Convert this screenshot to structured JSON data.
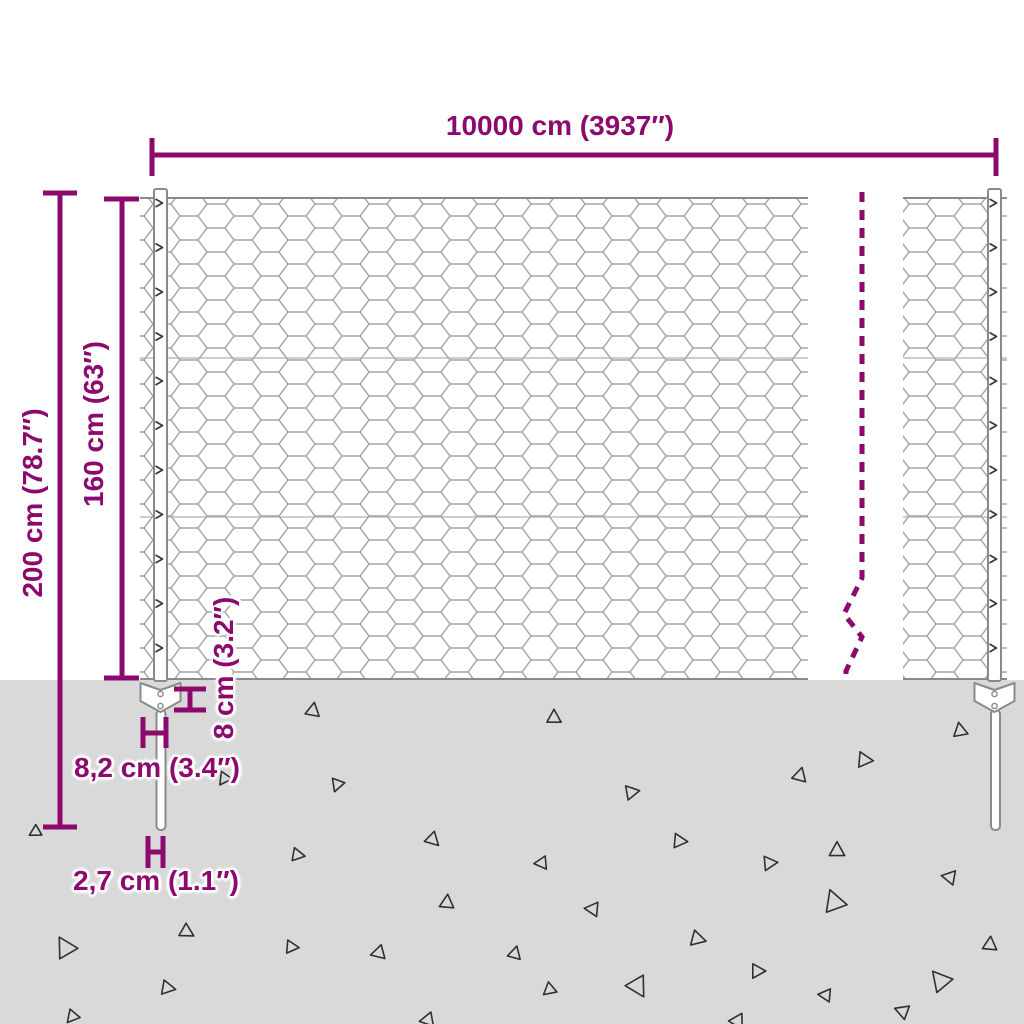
{
  "labels": {
    "total_width": "10000 cm (3937″)",
    "total_height": "200 cm (78.7″)",
    "mesh_height": "160 cm (63″)",
    "plate_height": "8 cm (3.2″)",
    "plate_width": "8,2 cm (3.4″)",
    "spike_width": "2,7 cm (1.1″)"
  },
  "colors": {
    "accent": "#8C0A6E",
    "background": "#FFFFFF",
    "ground": "#D9D9D9",
    "mesh_line": "#A3A3A3",
    "frame_line": "#8A8A8A",
    "triangle_line": "#303030"
  },
  "ground": {
    "triangles": [
      {
        "x": 313,
        "y": 710,
        "s": 13,
        "r": 10
      },
      {
        "x": 554,
        "y": 717,
        "s": 13,
        "r": 0
      },
      {
        "x": 960,
        "y": 730,
        "s": 13,
        "r": 350
      },
      {
        "x": 865,
        "y": 760,
        "s": 14,
        "r": 95
      },
      {
        "x": 800,
        "y": 775,
        "s": 13,
        "r": 15
      },
      {
        "x": 632,
        "y": 792,
        "s": 13,
        "r": 80
      },
      {
        "x": 337,
        "y": 785,
        "s": 12,
        "r": 200
      },
      {
        "x": 224,
        "y": 779,
        "s": 12,
        "r": 215
      },
      {
        "x": 35,
        "y": 832,
        "s": 11,
        "r": 240
      },
      {
        "x": 433,
        "y": 840,
        "s": 13,
        "r": 135
      },
      {
        "x": 298,
        "y": 855,
        "s": 12,
        "r": 100
      },
      {
        "x": 680,
        "y": 841,
        "s": 13,
        "r": 95
      },
      {
        "x": 837,
        "y": 850,
        "s": 14,
        "r": 0
      },
      {
        "x": 541,
        "y": 863,
        "s": 12,
        "r": 265
      },
      {
        "x": 770,
        "y": 863,
        "s": 13,
        "r": 85
      },
      {
        "x": 949,
        "y": 877,
        "s": 13,
        "r": 280
      },
      {
        "x": 447,
        "y": 902,
        "s": 13,
        "r": 5
      },
      {
        "x": 834,
        "y": 901,
        "s": 20,
        "r": 340
      },
      {
        "x": 592,
        "y": 909,
        "s": 13,
        "r": 275
      },
      {
        "x": 187,
        "y": 932,
        "s": 13,
        "r": 120
      },
      {
        "x": 65,
        "y": 947,
        "s": 19,
        "r": 330
      },
      {
        "x": 292,
        "y": 947,
        "s": 12,
        "r": 95
      },
      {
        "x": 378,
        "y": 953,
        "s": 13,
        "r": 255
      },
      {
        "x": 698,
        "y": 939,
        "s": 14,
        "r": 105
      },
      {
        "x": 515,
        "y": 953,
        "s": 12,
        "r": 15
      },
      {
        "x": 990,
        "y": 944,
        "s": 13,
        "r": 5
      },
      {
        "x": 758,
        "y": 971,
        "s": 13,
        "r": 90
      },
      {
        "x": 168,
        "y": 988,
        "s": 13,
        "r": 100
      },
      {
        "x": 549,
        "y": 990,
        "s": 12,
        "r": 230
      },
      {
        "x": 638,
        "y": 987,
        "s": 19,
        "r": 150
      },
      {
        "x": 825,
        "y": 995,
        "s": 12,
        "r": 275
      },
      {
        "x": 940,
        "y": 980,
        "s": 19,
        "r": 320
      },
      {
        "x": 902,
        "y": 1011,
        "s": 13,
        "r": 290
      },
      {
        "x": 72,
        "y": 1017,
        "s": 12,
        "r": 220
      },
      {
        "x": 427,
        "y": 1020,
        "s": 13,
        "r": 260
      },
      {
        "x": 738,
        "y": 1022,
        "s": 14,
        "r": 150
      }
    ]
  }
}
